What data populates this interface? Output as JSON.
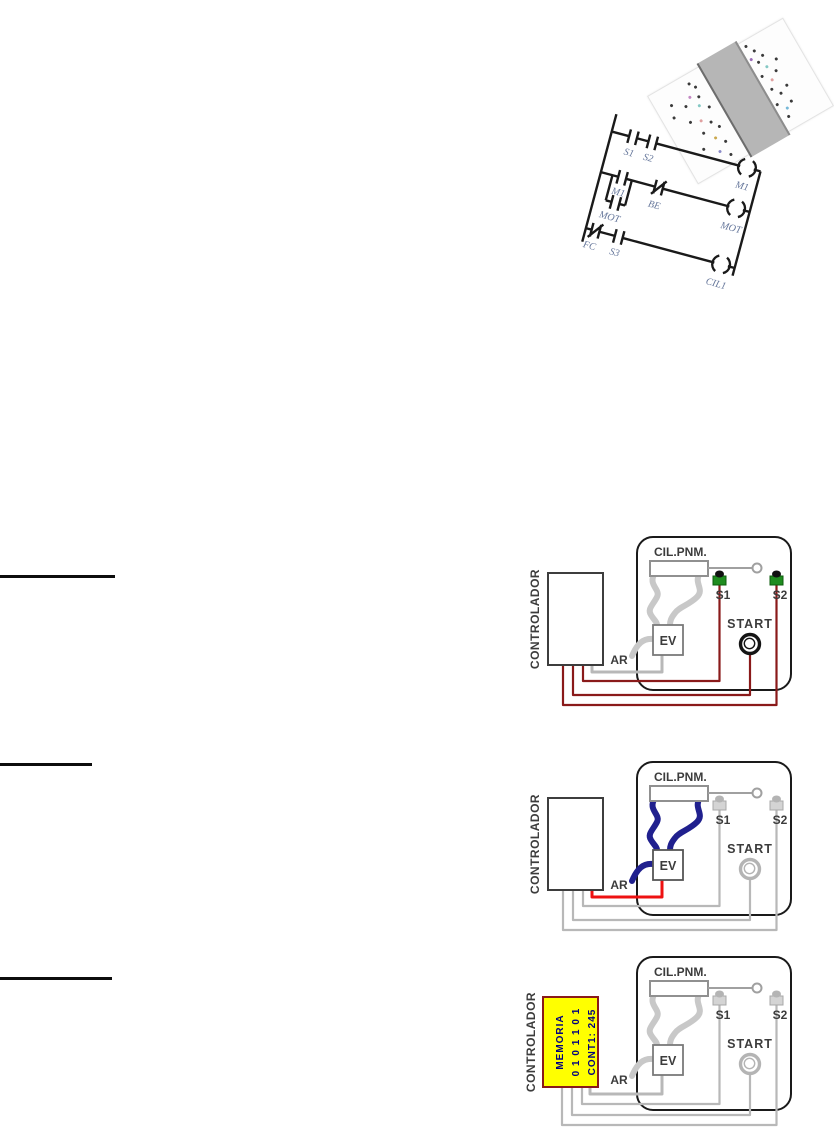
{
  "heading_rules": {
    "count": 3,
    "color": "#0d0d0d"
  },
  "pcb_photo": {
    "board_band_color": "#b6b6b6",
    "rotation_deg": -30
  },
  "ladder": {
    "line_color": "#1a1a1a",
    "label_color": "#66779b",
    "rung1": {
      "contact1": "S1",
      "contact2": "S2",
      "coil": "M1"
    },
    "rung2": {
      "contact1": "M1",
      "parallel_contact": "MOT",
      "nc_contact": "BE",
      "coil": "MOT"
    },
    "rung3": {
      "nc_contact": "FC",
      "contact": "S3",
      "coil": "CIL1"
    }
  },
  "diagrams": [
    {
      "controller_label": "CONTROLADOR",
      "panel": {
        "cylinder_label": "CIL.PNM.",
        "sensor1": "S1",
        "sensor2": "S2",
        "start_label": "START",
        "valve_label": "EV",
        "air_label": "AR"
      },
      "colors": {
        "signal_wire": "#8a1a1a",
        "valve_wire": "#b8b8b8",
        "tube": "#c8c8c8",
        "sensor_body": "#1f8c1f",
        "sensor_tip": "#101010",
        "start_ring": "#141414"
      }
    },
    {
      "controller_label": "CONTROLADOR",
      "panel": {
        "cylinder_label": "CIL.PNM.",
        "sensor1": "S1",
        "sensor2": "S2",
        "start_label": "START",
        "valve_label": "EV",
        "air_label": "AR"
      },
      "colors": {
        "signal_wire": "#b8b8b8",
        "valve_wire": "#ee1111",
        "tube": "#20208e",
        "sensor_body": "#d4d4d4",
        "sensor_tip": "#b4b4b4",
        "start_ring": "#b4b4b4"
      }
    },
    {
      "controller_label": "CONTROLADOR",
      "panel": {
        "cylinder_label": "CIL.PNM.",
        "sensor1": "S1",
        "sensor2": "S2",
        "start_label": "START",
        "valve_label": "EV",
        "air_label": "AR"
      },
      "colors": {
        "signal_wire": "#b8b8b8",
        "valve_wire": "#b8b8b8",
        "tube": "#c8c8c8",
        "sensor_body": "#d4d4d4",
        "sensor_tip": "#b4b4b4",
        "start_ring": "#b4b4b4"
      },
      "memory": {
        "line1": "MEMORIA",
        "line2": "0 1 0 1 1 0 1",
        "line3": "CONT1: 245",
        "bg": "#ffff00",
        "text_color": "#000080",
        "border": "#8a1a1a"
      }
    }
  ]
}
